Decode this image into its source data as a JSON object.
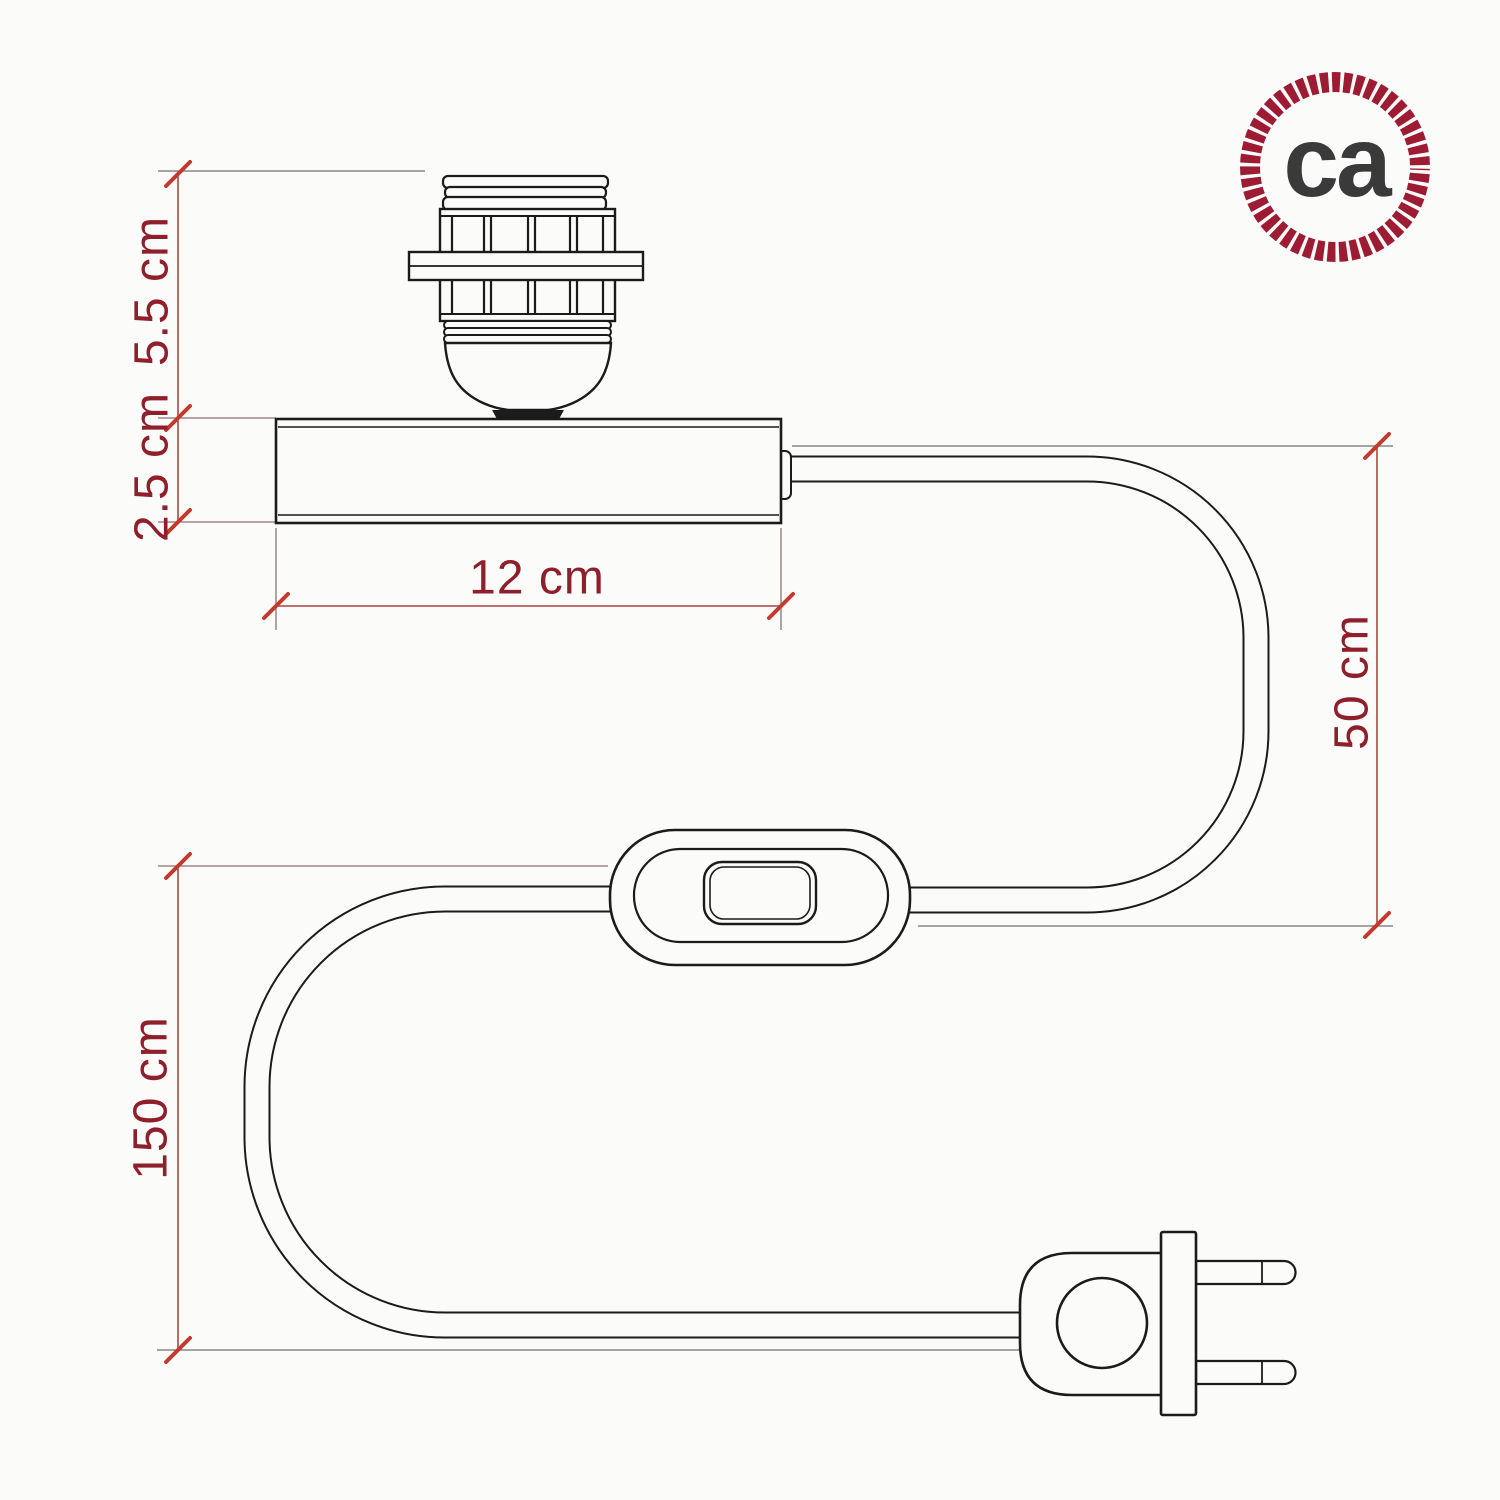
{
  "title": "Table lamp kit dimensional diagram",
  "dimensions": {
    "socket_height": "5.5 cm",
    "base_height": "2.5 cm",
    "base_width": "12 cm",
    "cable_base_to_switch": "50 cm",
    "cable_switch_to_plug": "150 cm"
  },
  "logo": {
    "text": "ca"
  },
  "colors": {
    "dimension_text": "#8e1f2b",
    "dimension_line": "#b0453c",
    "tick_mark": "#c23a2e",
    "extension_line": "#8c7272",
    "outline_ink": "#1b1b1b",
    "logo_ring": "#9e1c33",
    "logo_text": "#3a3a3a",
    "background": "#fbfbfa"
  }
}
